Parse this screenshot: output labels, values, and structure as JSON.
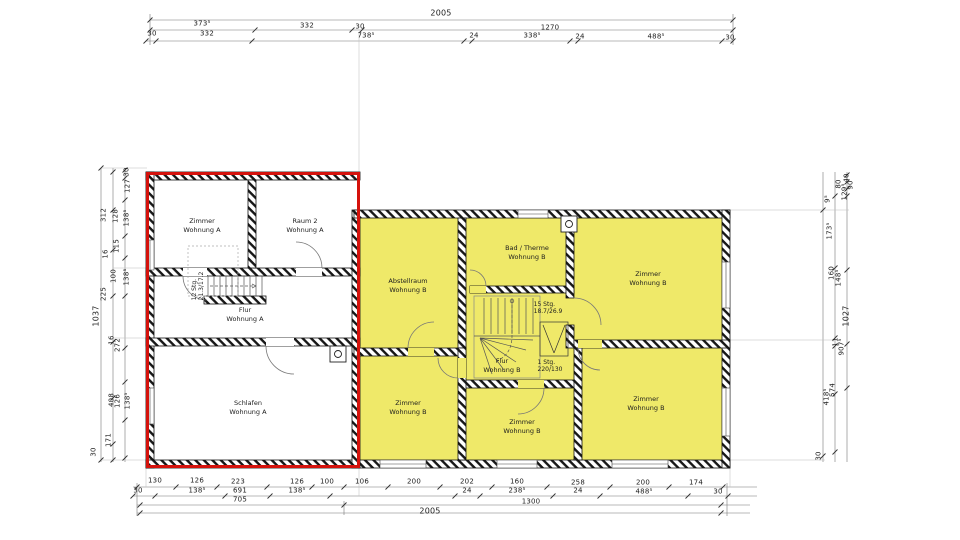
{
  "plan": {
    "title": "Obergeschoss Grundriss (scanned floor plan)",
    "colors": {
      "unit_a_outline": "#d5120c",
      "unit_b_fill": "#efe969",
      "wall": "#161616"
    },
    "rooms": [
      {
        "name": "Zimmer",
        "unit": "Wohnung A",
        "x": 202,
        "y": 226
      },
      {
        "name": "Raum 2",
        "unit": "Wohnung A",
        "x": 305,
        "y": 226
      },
      {
        "name": "Flur",
        "unit": "Wohnung A",
        "x": 245,
        "y": 315
      },
      {
        "name": "Schlafen",
        "unit": "Wohnung A",
        "x": 248,
        "y": 408
      },
      {
        "name": "Abstellraum",
        "unit": "Wohnung B",
        "x": 408,
        "y": 286
      },
      {
        "name": "Bad / Therme",
        "unit": "Wohnung B",
        "x": 527,
        "y": 253
      },
      {
        "name": "Zimmer",
        "unit": "Wohnung B",
        "x": 648,
        "y": 279
      },
      {
        "name": "Flur",
        "unit": "Wohnung B",
        "x": 502,
        "y": 366
      },
      {
        "name": "Zimmer",
        "unit": "Wohnung B",
        "x": 408,
        "y": 408
      },
      {
        "name": "Zimmer",
        "unit": "Wohnung B",
        "x": 522,
        "y": 427
      },
      {
        "name": "Zimmer",
        "unit": "Wohnung B",
        "x": 646,
        "y": 404
      }
    ],
    "stairs": [
      {
        "line1": "12 Stg.",
        "line2": "21.3/17.2",
        "x": 198,
        "y": 286,
        "rot": -90
      },
      {
        "line1": "15 Stg.",
        "line2": "18.7/26.9",
        "x": 548,
        "y": 308,
        "rot": 0
      },
      {
        "line1": "1 Stg.",
        "line2": "220/130",
        "x": 550,
        "y": 366,
        "rot": 0
      }
    ]
  },
  "dimension_labels": {
    "top": [
      {
        "t": "2005",
        "x": 441,
        "y": 13,
        "big": true
      },
      {
        "t": "373⁵",
        "x": 202,
        "y": 24
      },
      {
        "t": "332",
        "x": 307,
        "y": 26
      },
      {
        "t": "30",
        "x": 360,
        "y": 27
      },
      {
        "t": "1270",
        "x": 550,
        "y": 28
      },
      {
        "t": "30",
        "x": 152,
        "y": 34
      },
      {
        "t": "332",
        "x": 207,
        "y": 34
      },
      {
        "t": "738⁵",
        "x": 366,
        "y": 36
      },
      {
        "t": "24",
        "x": 474,
        "y": 36
      },
      {
        "t": "338⁵",
        "x": 532,
        "y": 36
      },
      {
        "t": "24",
        "x": 580,
        "y": 37
      },
      {
        "t": "488⁵",
        "x": 656,
        "y": 37
      },
      {
        "t": "30",
        "x": 730,
        "y": 38
      }
    ],
    "bottom": [
      {
        "t": "130",
        "x": 155,
        "y": 481
      },
      {
        "t": "126",
        "x": 197,
        "y": 481
      },
      {
        "t": "223",
        "x": 238,
        "y": 482
      },
      {
        "t": "126",
        "x": 297,
        "y": 482
      },
      {
        "t": "100",
        "x": 327,
        "y": 482
      },
      {
        "t": "106",
        "x": 362,
        "y": 482
      },
      {
        "t": "200",
        "x": 414,
        "y": 482
      },
      {
        "t": "202",
        "x": 467,
        "y": 482
      },
      {
        "t": "160",
        "x": 517,
        "y": 482
      },
      {
        "t": "258",
        "x": 578,
        "y": 483
      },
      {
        "t": "200",
        "x": 643,
        "y": 483
      },
      {
        "t": "174",
        "x": 696,
        "y": 483
      },
      {
        "t": "30",
        "x": 138,
        "y": 491
      },
      {
        "t": "138⁵",
        "x": 197,
        "y": 491
      },
      {
        "t": "691",
        "x": 240,
        "y": 491
      },
      {
        "t": "138⁵",
        "x": 297,
        "y": 491
      },
      {
        "t": "24",
        "x": 467,
        "y": 491
      },
      {
        "t": "238⁵",
        "x": 517,
        "y": 491
      },
      {
        "t": "24",
        "x": 578,
        "y": 491
      },
      {
        "t": "488⁵",
        "x": 644,
        "y": 492
      },
      {
        "t": "30",
        "x": 718,
        "y": 492
      },
      {
        "t": "705",
        "x": 240,
        "y": 500
      },
      {
        "t": "1300",
        "x": 531,
        "y": 502
      },
      {
        "t": "2005",
        "x": 430,
        "y": 511,
        "big": true
      }
    ],
    "left": [
      {
        "t": "30",
        "x": 127,
        "y": 172,
        "rot": -90
      },
      {
        "t": "127",
        "x": 128,
        "y": 186,
        "rot": -90
      },
      {
        "t": "312",
        "x": 104,
        "y": 215,
        "rot": -90
      },
      {
        "t": "128",
        "x": 116,
        "y": 216,
        "rot": -90
      },
      {
        "t": "138⁵",
        "x": 127,
        "y": 218,
        "rot": -90
      },
      {
        "t": "115",
        "x": 117,
        "y": 246,
        "rot": -90
      },
      {
        "t": "16",
        "x": 106,
        "y": 254,
        "rot": -90
      },
      {
        "t": "100",
        "x": 114,
        "y": 276,
        "rot": -90
      },
      {
        "t": "138⁵",
        "x": 127,
        "y": 277,
        "rot": -90
      },
      {
        "t": "225",
        "x": 104,
        "y": 294,
        "rot": -90
      },
      {
        "t": "1037",
        "x": 96,
        "y": 316,
        "rot": -90,
        "big": true
      },
      {
        "t": "16",
        "x": 112,
        "y": 340,
        "rot": -90
      },
      {
        "t": "272",
        "x": 118,
        "y": 345,
        "rot": -90
      },
      {
        "t": "408",
        "x": 112,
        "y": 400,
        "rot": -90
      },
      {
        "t": "126",
        "x": 118,
        "y": 401,
        "rot": -90
      },
      {
        "t": "138⁵",
        "x": 128,
        "y": 401,
        "rot": -90
      },
      {
        "t": "171",
        "x": 109,
        "y": 440,
        "rot": -90
      },
      {
        "t": "30",
        "x": 94,
        "y": 452,
        "rot": -90
      }
    ],
    "right": [
      {
        "t": "40",
        "x": 847,
        "y": 178,
        "rot": -90
      },
      {
        "t": "90",
        "x": 851,
        "y": 185,
        "rot": -90
      },
      {
        "t": "80",
        "x": 839,
        "y": 184,
        "rot": -90
      },
      {
        "t": "129⁵",
        "x": 845,
        "y": 192,
        "rot": -90
      },
      {
        "t": "9⁵",
        "x": 828,
        "y": 199,
        "rot": -90
      },
      {
        "t": "173⁵",
        "x": 830,
        "y": 231,
        "rot": -90
      },
      {
        "t": "160",
        "x": 832,
        "y": 273,
        "rot": -90
      },
      {
        "t": "148⁵",
        "x": 839,
        "y": 278,
        "rot": -90
      },
      {
        "t": "1027",
        "x": 846,
        "y": 316,
        "rot": -90,
        "big": true
      },
      {
        "t": "11",
        "x": 836,
        "y": 342,
        "rot": -90
      },
      {
        "t": "907⁵",
        "x": 842,
        "y": 347,
        "rot": -90
      },
      {
        "t": "574",
        "x": 833,
        "y": 390,
        "rot": -90
      },
      {
        "t": "418⁵",
        "x": 827,
        "y": 397,
        "rot": -90
      },
      {
        "t": "30",
        "x": 819,
        "y": 456,
        "rot": -90
      }
    ]
  }
}
